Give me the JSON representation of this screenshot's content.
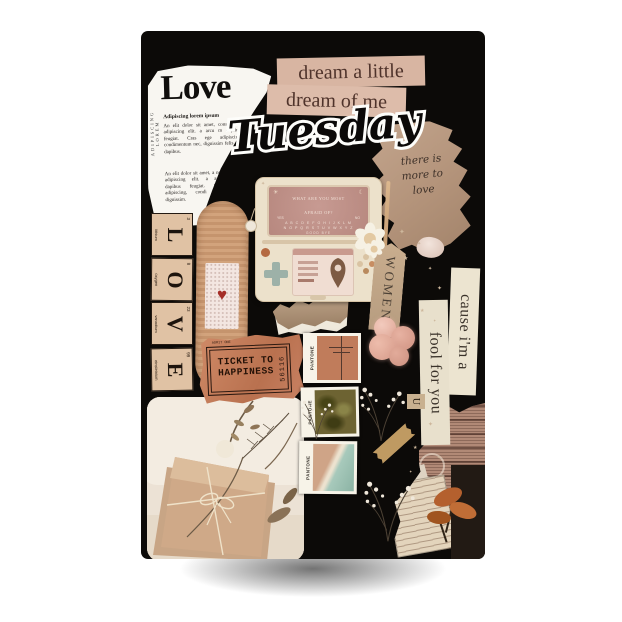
{
  "poster": {
    "alt": "Tuesday aesthetic collage moodboard poster"
  },
  "newspaper": {
    "side_text": "ADIPISCING LOREM",
    "headline": "Love",
    "subhead": "Adipiscing lorem ipsum",
    "para1": "An elit dolor sit amet, consec nor adipiscing elit. a arcu m dapibus feugiat. Cras ege adipiscing, condimentum nec, dignissim felis a q dapibus.",
    "para2": "An elit dolor sit amet, a nor adipiscing elit. a arcu dapibus feugiat. Cras adipiscing, condi nec, dignissim."
  },
  "strips": {
    "dream1": "dream a little",
    "dream2": "dream of me",
    "cause": "cause i'm a",
    "fool": "fool for you",
    "women": "WOMEN"
  },
  "day": "Tuesday",
  "note": {
    "line1": "there is",
    "line2": "more to",
    "line3": "love"
  },
  "tiles": [
    {
      "letter": "L",
      "name": "lithium",
      "number": "3"
    },
    {
      "letter": "O",
      "name": "oxygen",
      "number": "8"
    },
    {
      "letter": "V",
      "name": "vanadium",
      "number": "23"
    },
    {
      "letter": "E",
      "name": "einsteinium",
      "number": "99"
    }
  ],
  "ticket": {
    "line1": "TICKET TO",
    "line2": "HAPPINESS",
    "serial": "56116",
    "corner": "ADMIT ONE"
  },
  "device": {
    "q1": "WHAT ARE YOU MOST",
    "q2": "AFRAID OF?",
    "yes": "YES",
    "no": "NO",
    "row1": "A B C D E F G H I J K L M",
    "row2": "N O P Q R S T U V W X Y Z",
    "bye": "GOOD BYE"
  },
  "pantone": {
    "brand": "PANTONE"
  },
  "chip_letter": "U",
  "colors": {
    "poster_bg": "#0c0a08",
    "paper_beige": "#d8b5a2",
    "cream": "#ece4d0",
    "kraft": "#b3947b",
    "ticket": "#c07a58",
    "bandaid": "#cfa077",
    "device_body": "#ece1cb",
    "screen_pink": "#c29089",
    "accent_red": "#a52e28"
  }
}
